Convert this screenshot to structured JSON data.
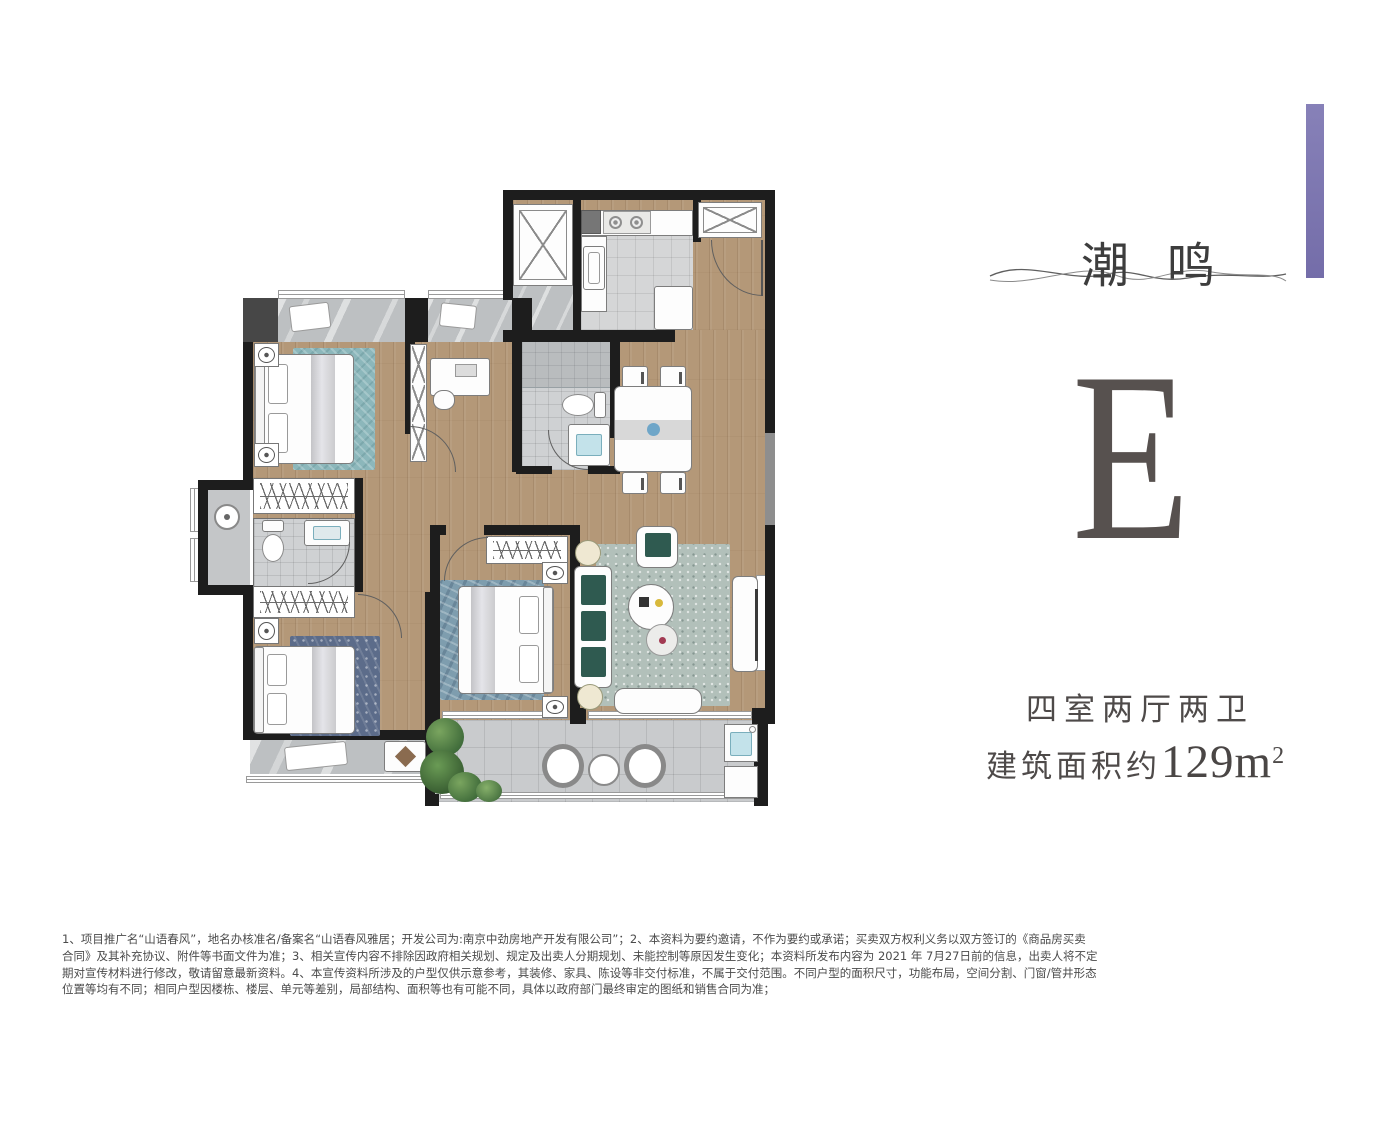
{
  "brand": {
    "logo_char_1": "潮",
    "logo_char_2": "鸣",
    "accent_bar_color": "#7d76b3"
  },
  "unit": {
    "letter": "E",
    "layout": "四室两厅两卫",
    "area_prefix": "建筑面积约",
    "area_value": "129m",
    "area_sup": "2"
  },
  "disclaimer": {
    "lines": [
      "1、项目推广名“山语春风”，地名办核准名/备案名“山语春风雅居；开发公司为:南京中劲房地产开发有限公司”；2、本资料为要约邀请，不作为要约或承诺；买卖双方权利义务以双方签订的《商品房买卖",
      "合同》及其补充协议、附件等书面文件为准；3、相关宣传内容不排除因政府相关规划、规定及出卖人分期规划、未能控制等原因发生变化；本资料所发布内容为 2021 年 7月27日前的信息，出卖人将不定",
      "期对宣传材料进行修改，敬请留意最新资料。4、本宣传资料所涉及的户型仅供示意参考，其装修、家具、陈设等非交付标准，不属于交付范围。不同户型的面积尺寸，功能布局，空间分割、门窗/管井形态",
      "位置等均有不同；相同户型因楼栋、楼层、单元等差别，局部结构、面积等也有可能不同，具体以政府部门最终审定的图纸和销售合同为准；"
    ]
  },
  "floorplan": {
    "palette": {
      "wall": "#1d1d1d",
      "wood_floor": "#b49878",
      "tile_floor": "#d5d6d7",
      "balcony_tile": "#c9cbcd",
      "rug_teal": "#8cb7bb",
      "rug_slate_blue": "#7e9dae",
      "rug_navy": "#5c6c8a",
      "rug_living": "#b2c0ba",
      "sofa_cushion_green": "#2f5a50",
      "plant_green": "#4e7d44",
      "sink_blue": "#c3e2ea"
    }
  }
}
